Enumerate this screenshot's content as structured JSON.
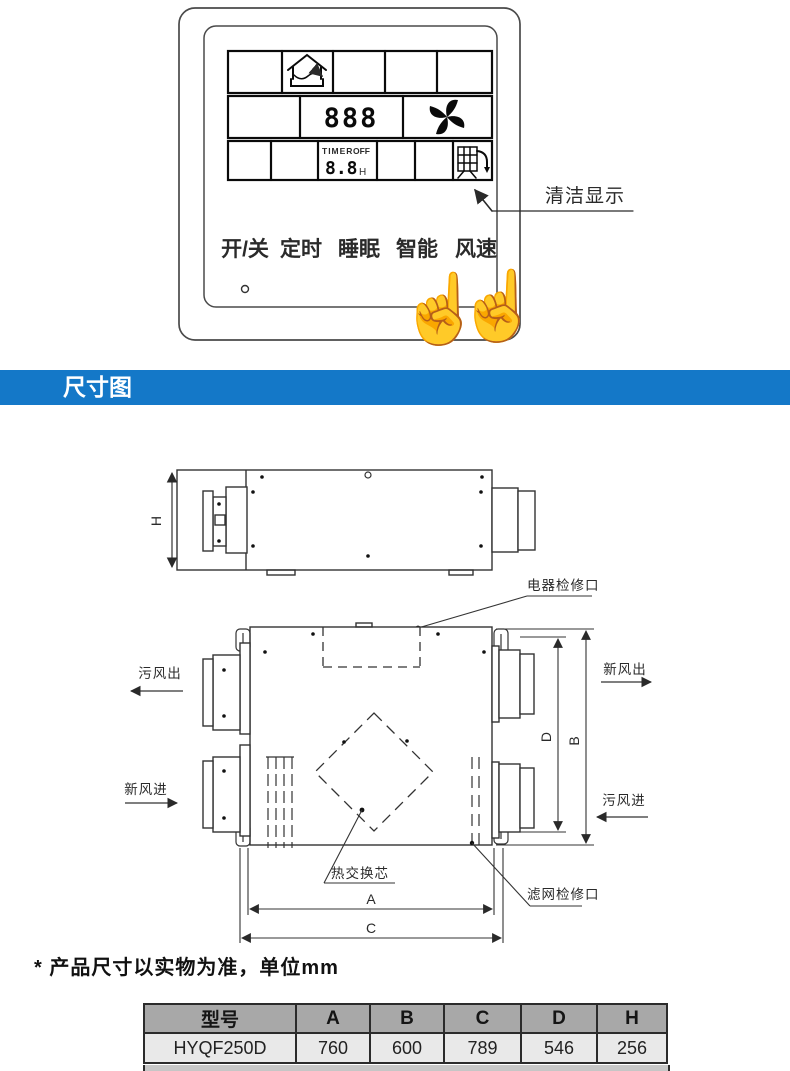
{
  "control_panel": {
    "buttons": [
      "开/关",
      "定时",
      "睡眠",
      "智能",
      "风速"
    ],
    "display": {
      "main_digits": "888",
      "timer_label": "TIMER",
      "timer_state": "OFF",
      "timer_digits": "8.8",
      "timer_unit": "H"
    },
    "callout_label": "清洁显示",
    "icons": {
      "mode": "house-ventilation-icon",
      "fan": "fan-icon",
      "clean": "filter-clean-icon",
      "hand": "pointing-hand-icon",
      "hand_glyph": "☝"
    }
  },
  "banner": {
    "title": "尺寸图",
    "bg_color": "#1478c8"
  },
  "drawing": {
    "dims": {
      "h": "H",
      "a": "A",
      "b": "B",
      "c": "C",
      "d": "D"
    },
    "labels": {
      "electric_access": "电器检修口",
      "dirty_air_out": "污风出",
      "fresh_air_in": "新风进",
      "fresh_air_out": "新风出",
      "dirty_air_in": "污风进",
      "heat_exchange_core": "热交换芯",
      "filter_access": "滤网检修口"
    }
  },
  "note": "* 产品尺寸以实物为准，单位mm",
  "spec_table": {
    "headers": [
      "型号",
      "A",
      "B",
      "C",
      "D",
      "H"
    ],
    "rows": [
      [
        "HYQF250D",
        "760",
        "600",
        "789",
        "546",
        "256"
      ]
    ]
  }
}
